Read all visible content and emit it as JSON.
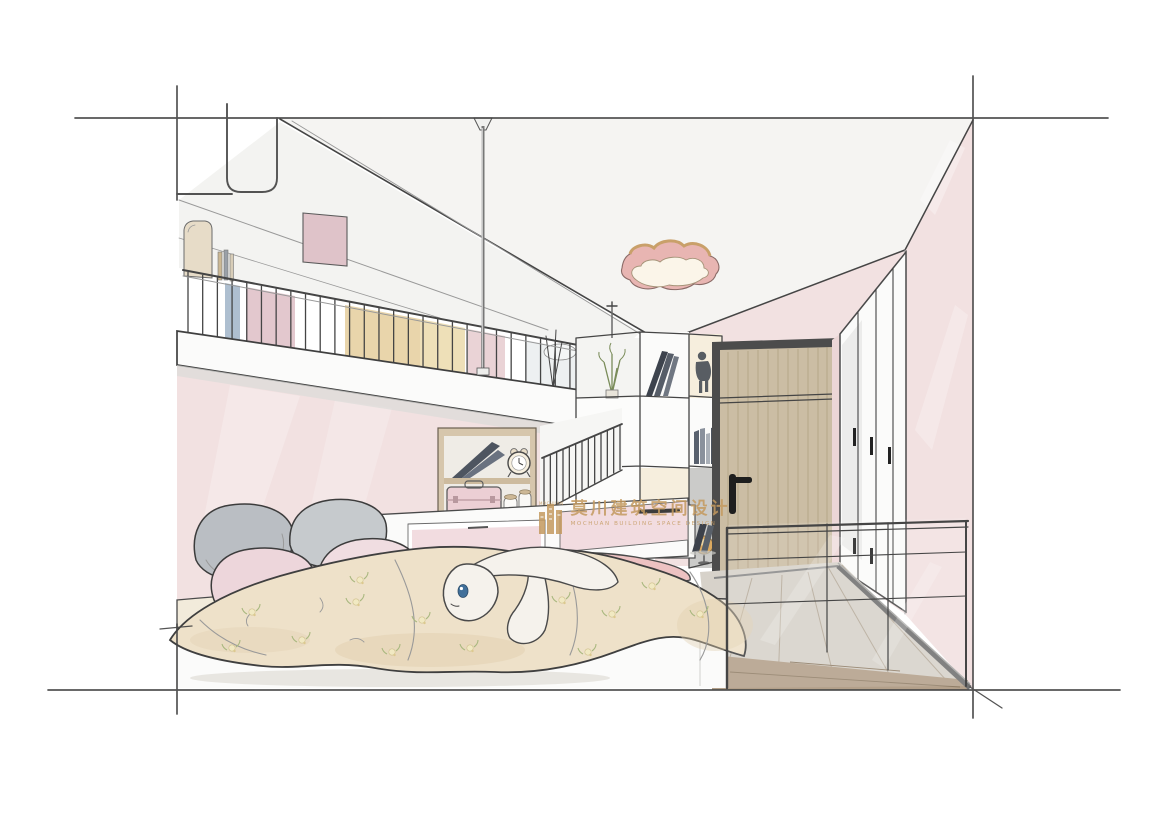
{
  "watermark": {
    "cn": "莫川建筑空间设计",
    "en": "MOCHUAN BUILDING SPACE DESIGN",
    "logo_label": "MOCHUAN",
    "color": "#c49a5f"
  },
  "palette": {
    "paper": "#ffffff",
    "line": "#454545",
    "wall-pink": "#f2e1e1",
    "wall-pink-light": "#f8eeee",
    "ceiling-tint": "#f5f4f2",
    "loft-white": "#fbfbfa",
    "shadow-gray": "#dcdcd9",
    "duvet": "#eee1c9",
    "duvet-shade": "#e0cfae",
    "mattress": "#f2ebdb",
    "pillow-gray": "#babec3",
    "pillow-gray2": "#c6cacd",
    "pillow-pink": "#edd6db",
    "pillow-pink2": "#f0dde1",
    "plush-white": "#f5f2ec",
    "plush-pink": "#edc2c2",
    "plush-eye": "#41709a",
    "lamp-pink": "#e8b5b2",
    "lamp-rim": "#c9a06a",
    "lamp-face": "#fbf5e9",
    "gold": "#c49a5f",
    "door-wood": "#cbbda4",
    "door-frame": "#4c4c4c",
    "floor-wood": "#b3a08a",
    "floor-light": "#d7d2ca",
    "furniture-white": "#fbfbfa",
    "drawer-pink": "#f2dce0",
    "case-pink": "#eccfd4",
    "cabinet-tan": "#e9d5ab",
    "cabinet-blue": "#aebfd0",
    "book-dark": "#454b55",
    "metal": "#6f7377",
    "glow": "#f6eedd",
    "plant-green": "#7a8c5a",
    "globe-amber": "#dcaa60",
    "wood-frame": "#d6c6ac"
  }
}
